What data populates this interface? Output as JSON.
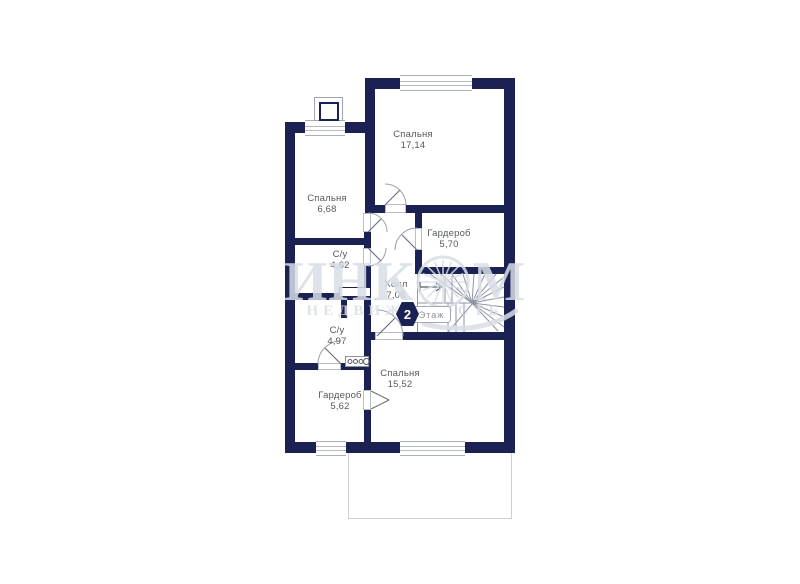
{
  "watermark": {
    "brand_full": "ИНКОМ",
    "brand_pre": "ИНК",
    "brand_post": "М",
    "subtitle": "НЕДВИЖИМОСТЬ"
  },
  "floor_badge": {
    "number": "2",
    "label": "Этаж"
  },
  "rooms": [
    {
      "name": "Спальня",
      "area": "17,14"
    },
    {
      "name": "Спальня",
      "area": "6,68"
    },
    {
      "name": "Гардероб",
      "area": "5,70"
    },
    {
      "name": "С/у",
      "area": "4,62"
    },
    {
      "name": "Холл",
      "area": "7,06"
    },
    {
      "name": "С/у",
      "area": "4,97"
    },
    {
      "name": "Спальня",
      "area": "15,52"
    },
    {
      "name": "Гардероб",
      "area": "5,62"
    }
  ],
  "colors": {
    "wall": "#1b2153",
    "watermark": "#d9dde6",
    "label_text": "#55595f",
    "badge_background": "#1b2153"
  }
}
